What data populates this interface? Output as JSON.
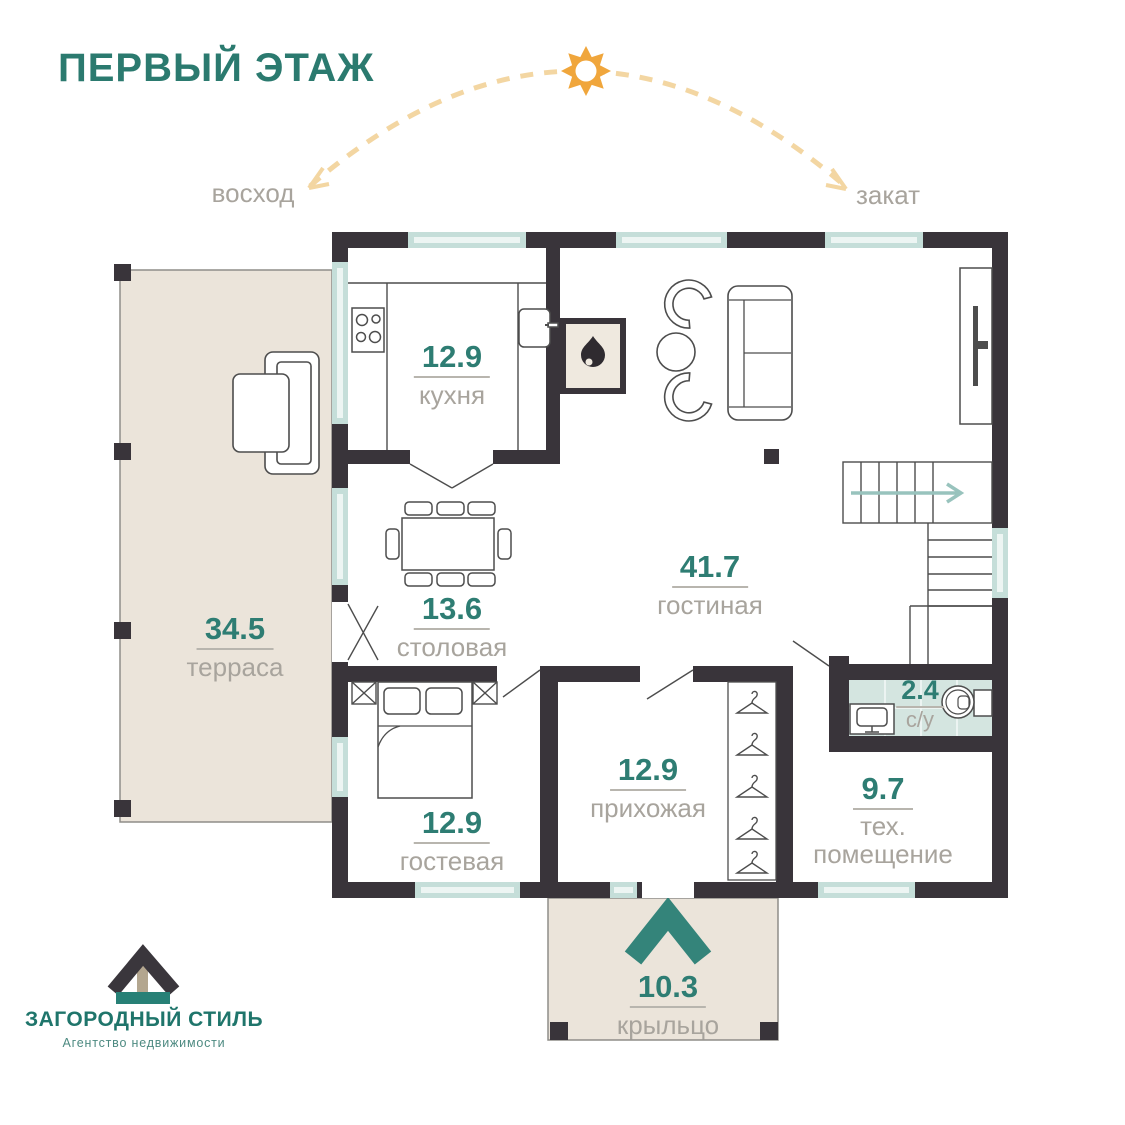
{
  "title": "ПЕРВЫЙ ЭТАЖ",
  "orientation": {
    "sunrise": "восход",
    "sunset": "закат"
  },
  "rooms": {
    "kitchen": {
      "area": "12.9",
      "name": "кухня"
    },
    "dining": {
      "area": "13.6",
      "name": "столовая"
    },
    "living": {
      "area": "41.7",
      "name": "гостиная"
    },
    "terrace": {
      "area": "34.5",
      "name": "терраса"
    },
    "guest": {
      "area": "12.9",
      "name": "гостевая"
    },
    "hallway": {
      "area": "12.9",
      "name": "прихожая"
    },
    "bathroom": {
      "area": "2.4",
      "name": "с/у"
    },
    "tech": {
      "area": "9.7",
      "name": "тех. помещение"
    },
    "porch": {
      "area": "10.3",
      "name": "крыльцо"
    }
  },
  "logo": {
    "brand": "ЗАГОРОДНЫЙ СТИЛЬ",
    "subtitle": "Агентство недвижимости"
  },
  "icons": {
    "sun": "sun-icon",
    "flame": "fireplace-flame-icon",
    "stairs_arrow": "stairs-direction-arrow",
    "entrance_arrow": "entrance-chevron-icon",
    "logo_house": "logo-house-icon",
    "hanger": "hanger-icon"
  },
  "colors": {
    "accent_teal": "#2e7d73",
    "wall_dark": "#39343a",
    "window_teal": "#c5ded9",
    "beige": "#ebe4da",
    "label_gray": "#a8a49d",
    "sun_orange": "#f0a63c",
    "arc_orange": "#f3d6a2",
    "tile_teal": "#d4e5e0"
  }
}
